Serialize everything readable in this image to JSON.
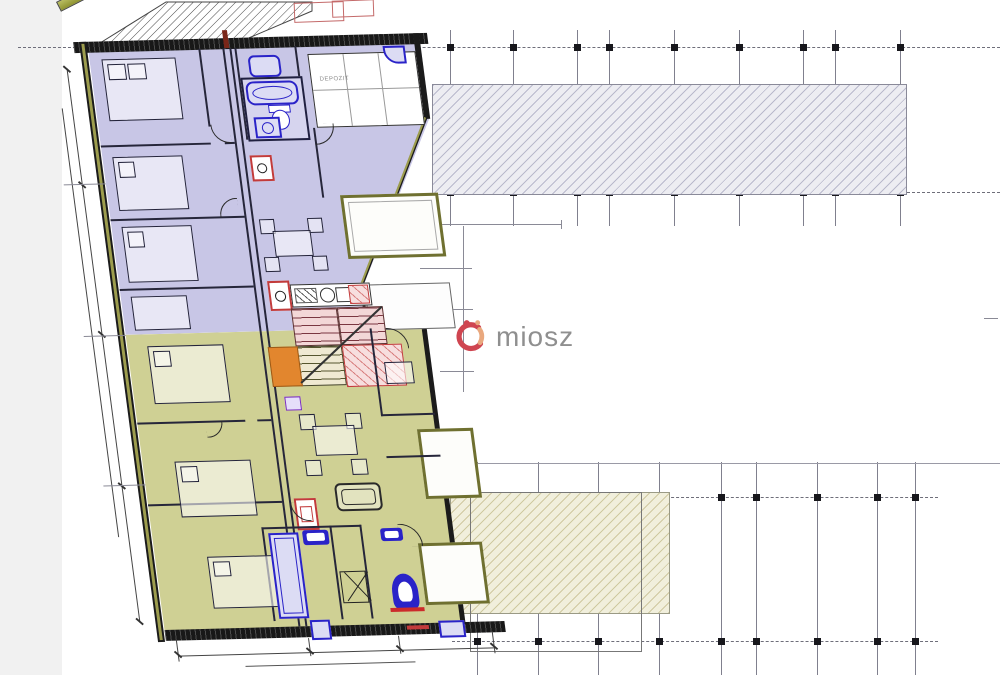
{
  "watermark": {
    "brand": "miosz"
  },
  "rooms": {
    "storage": "DEPOZIT"
  },
  "palette": {
    "upper_unit_fill": "#c8c6e6",
    "lower_unit_fill": "#cfd094",
    "stair_fill": "#f3d7d7",
    "stair_line": "#c23b3b",
    "landing_orange": "#e2862e",
    "fixture_blue": "#2a23c8",
    "wall_dark": "#1b1b1b",
    "wall_olive": "#6f7030",
    "grid_gray": "#80808e",
    "slab_hatch_gray": "#b9b9cc",
    "slab_hatch_yellow": "#cfc9a0",
    "watermark_gray": "#8f8f8f",
    "logo_red": "#cf4550",
    "logo_orange": "#e9a87e"
  },
  "grids": {
    "top": {
      "verticals": [
        450,
        513,
        577,
        609,
        674,
        739,
        803,
        835,
        900
      ],
      "vspan": [
        30,
        226
      ],
      "axes": [
        {
          "y": 47,
          "x1": 18,
          "x2": 1000
        },
        {
          "y": 192,
          "x1": 432,
          "x2": 1000
        }
      ],
      "marker_y": [
        47,
        192
      ]
    },
    "bottom": {
      "verticals": [
        477,
        538,
        598,
        659,
        721,
        756,
        817,
        877,
        915
      ],
      "vspan": [
        462,
        675
      ],
      "axes": [
        {
          "y": 497,
          "x1": 452,
          "x2": 938
        },
        {
          "y": 641,
          "x1": 452,
          "x2": 938
        }
      ],
      "solid": [
        {
          "y": 463,
          "x1": 440,
          "x2": 1000
        }
      ],
      "marker_y": [
        497,
        641
      ]
    }
  }
}
